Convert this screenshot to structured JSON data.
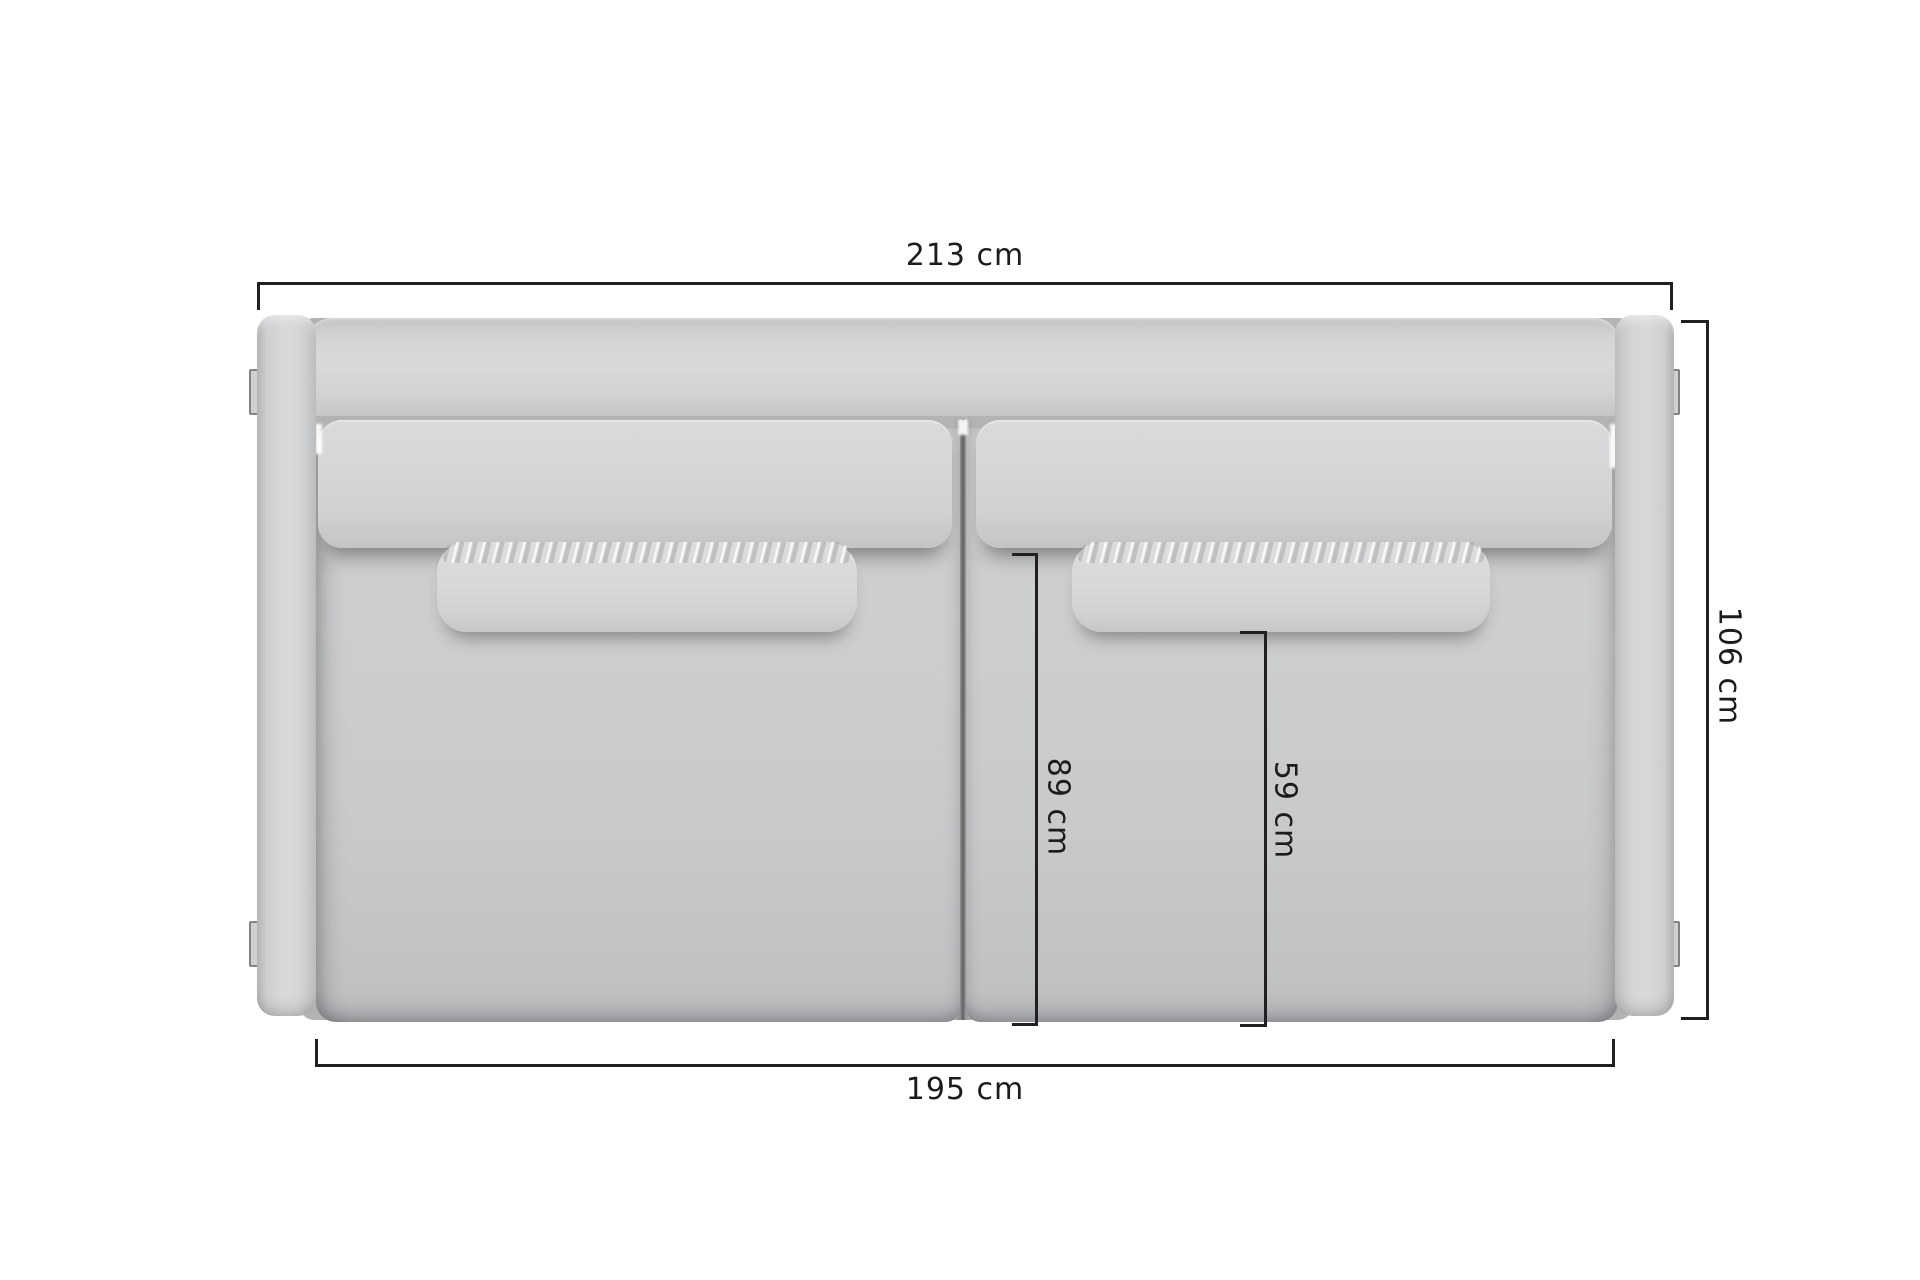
{
  "diagram": {
    "subject": "sofa top view dimension drawing",
    "unit": "cm"
  },
  "dimensions": {
    "total_width": {
      "label": "213 cm",
      "value": 213,
      "position": "top"
    },
    "total_depth": {
      "label": "106 cm",
      "value": 106,
      "position": "right"
    },
    "seat_width": {
      "label": "195 cm",
      "value": 195,
      "position": "bottom"
    },
    "seat_depth_from_backrest": {
      "label": "89 cm",
      "value": 89,
      "position": "inner-left"
    },
    "seat_depth_from_pillow": {
      "label": "59 cm",
      "value": 59,
      "position": "inner-right"
    }
  },
  "colors": {
    "background": "#ffffff",
    "dimension_line": "#202022",
    "label_text": "#1c1c1d",
    "sofa_light": "#d8d9db",
    "sofa_mid": "#cccdcf",
    "sofa_shadow": "#b2b3b5",
    "crevice": "#5d5e60"
  }
}
